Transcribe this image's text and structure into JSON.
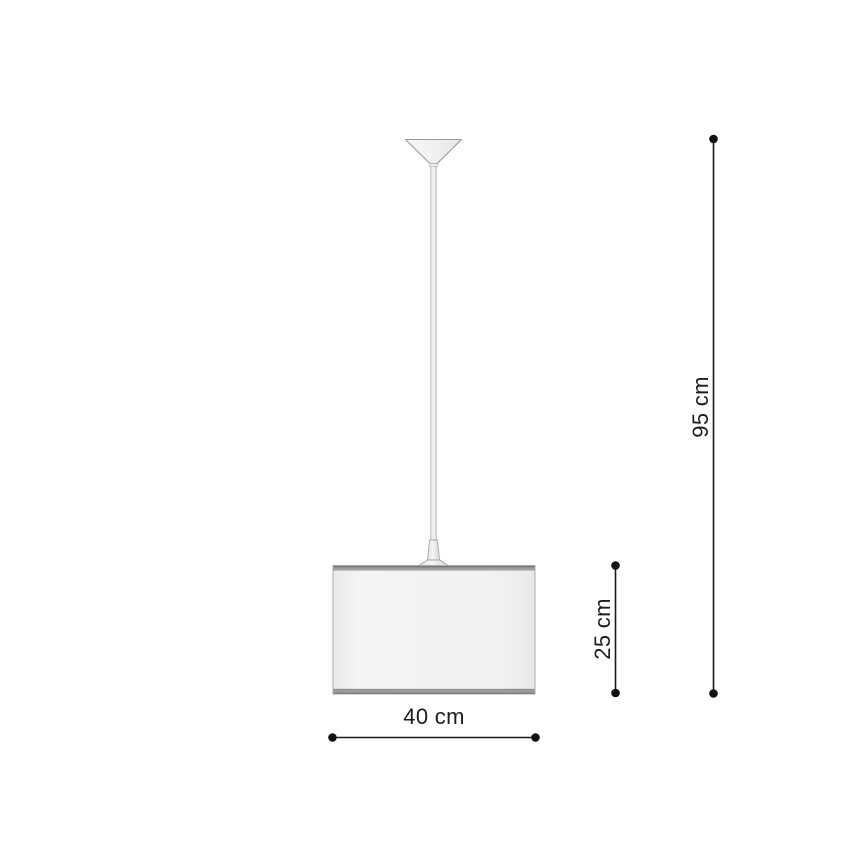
{
  "page": {
    "background_color": "#ffffff",
    "kind": "product-dimension-diagram",
    "subject": "pendant-lamp"
  },
  "lamp": {
    "parts": [
      "ceiling-canopy",
      "suspension-cable",
      "socket-holder",
      "drum-lampshade"
    ],
    "colors": {
      "outline": "#9a9a9a",
      "canopy_fill": "#f0f0f0",
      "cable_fill": "#ececec",
      "shade_fill": "#f2f2f2",
      "shade_band": "#9e9e9e"
    }
  },
  "dimensions": {
    "line_color": "#1a1a1a",
    "total_height": {
      "label": "95 cm",
      "value": 95,
      "unit": "cm",
      "orientation": "vertical"
    },
    "shade_height": {
      "label": "25 cm",
      "value": 25,
      "unit": "cm",
      "orientation": "vertical"
    },
    "shade_width": {
      "label": "40 cm",
      "value": 40,
      "unit": "cm",
      "orientation": "horizontal"
    }
  }
}
